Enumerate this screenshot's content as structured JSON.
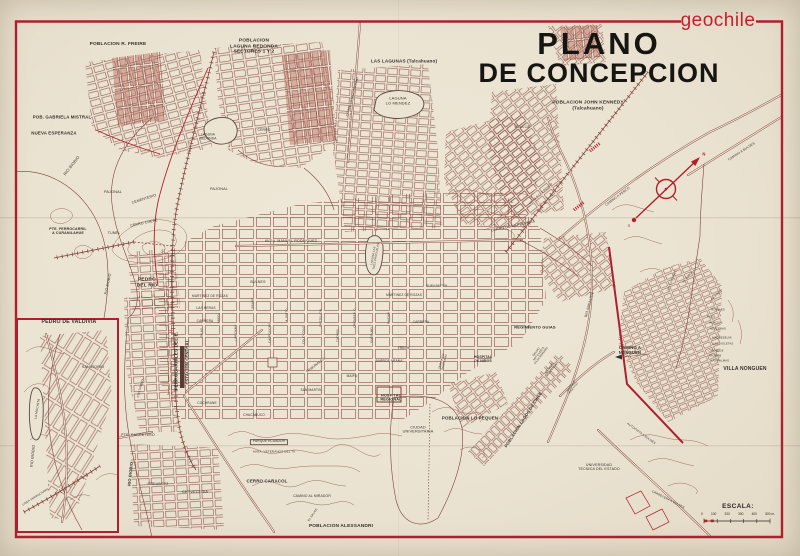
{
  "header": {
    "brand": "geochile",
    "title_line1": "PLANO",
    "title_line2": "DE CONCEPCION"
  },
  "scale": {
    "label": "ESCALA:",
    "marks": [
      "0",
      "100",
      "200",
      "300",
      "400",
      "500 m."
    ]
  },
  "colors": {
    "accent_red": "#ad2030",
    "brand_red": "#c2202e",
    "map_line": "#7d4038",
    "paper": "#ebe3d2",
    "ink": "#35302a"
  },
  "map_labels": [
    {
      "n": "poblacion-r-freire",
      "t": "POBLACION R. FREIRE",
      "x": 118,
      "y": 45,
      "s": 4.8,
      "b": true
    },
    {
      "n": "poblacion-laguna-redonda",
      "t": "POBLACION\nLAGUNA REDONDA\nSECTORES 1 Y 2",
      "x": 254,
      "y": 47,
      "s": 4.8,
      "b": true
    },
    {
      "n": "las-lagunas",
      "t": "LAS LAGUNAS (Talcahuano)",
      "x": 404,
      "y": 61,
      "s": 4.6,
      "b": true
    },
    {
      "n": "laguna-lo-mendez",
      "t": "LAGUNA\nLO MENDEZ",
      "x": 398,
      "y": 101,
      "s": 4
    },
    {
      "n": "poblacion-john-kennedy",
      "t": "POBLACION JOHN KENNEDY\n(Talcahuano)",
      "x": 588,
      "y": 106,
      "s": 4.8,
      "b": true
    },
    {
      "n": "pob-gabriela-mistral",
      "t": "POB. GABRIELA MISTRAL",
      "x": 62,
      "y": 117,
      "s": 4.4,
      "b": true
    },
    {
      "n": "nueva-esperanza",
      "t": "NUEVA ESPERANZA",
      "x": 54,
      "y": 133,
      "s": 4.4,
      "b": true
    },
    {
      "n": "camino-a-talcahuano",
      "t": "CAMINO A TALCAHUANO",
      "x": 353,
      "y": 97,
      "s": 3.2,
      "r": -75
    },
    {
      "n": "villa-cap",
      "t": "VILLA CAP",
      "x": 523,
      "y": 128,
      "s": 3.2
    },
    {
      "n": "cerro",
      "t": "CERRO",
      "x": 264,
      "y": 131,
      "s": 3.4
    },
    {
      "n": "laguna-redonda-small",
      "t": "LAGUNA\nREDONDA",
      "x": 208,
      "y": 137,
      "s": 3.2
    },
    {
      "n": "rio-biobio-nw",
      "t": "RIO BIOBIO",
      "x": 72,
      "y": 166,
      "s": 4,
      "r": -52
    },
    {
      "n": "pajonal-w",
      "t": "PAJONAL",
      "x": 113,
      "y": 192,
      "s": 3.8
    },
    {
      "n": "pajonal-c",
      "t": "PAJONAL",
      "x": 219,
      "y": 189,
      "s": 3.8
    },
    {
      "n": "cementerio",
      "t": "CEMENTERIO",
      "x": 144,
      "y": 199,
      "s": 3.6,
      "r": -18
    },
    {
      "n": "cerro-chepe",
      "t": "CERRO CHEPE",
      "x": 144,
      "y": 223,
      "s": 3.6,
      "r": -12
    },
    {
      "n": "tunel",
      "t": "TUNEL",
      "x": 114,
      "y": 233,
      "s": 3.6
    },
    {
      "n": "pte-ferrocarril",
      "t": "PTE. FERROCARRIL\nA CURANILAHUE",
      "x": 68,
      "y": 231,
      "s": 3.6,
      "b": true
    },
    {
      "n": "pedro-del-rio",
      "t": "PEDRO\nDEL RIO",
      "x": 147,
      "y": 283,
      "s": 4.8,
      "b": true
    },
    {
      "n": "rio-biobio-w",
      "t": "RIO BIOBIO",
      "x": 108,
      "y": 284,
      "s": 3.6,
      "r": -78
    },
    {
      "n": "ferrocarriles-del-e",
      "t": "FERROCARRILES DEL E.",
      "x": 176,
      "y": 361,
      "s": 4.6,
      "r": -90,
      "b": true
    },
    {
      "n": "estacion-central",
      "t": "ESTACION CENTRAL",
      "x": 188,
      "y": 362,
      "s": 4.2,
      "r": -90,
      "b": true
    },
    {
      "n": "pte-carretero",
      "t": "PTE. CARRETERO",
      "x": 138,
      "y": 435,
      "s": 3.6
    },
    {
      "n": "costanera",
      "t": "COSTANERA",
      "x": 141,
      "y": 388,
      "s": 3,
      "r": -75
    },
    {
      "n": "rio-biobio-sw",
      "t": "RIO BIOBIO",
      "x": 131,
      "y": 474,
      "s": 4,
      "r": -84,
      "b": true
    },
    {
      "n": "fernandez",
      "t": "FERNANDEZ",
      "x": 158,
      "y": 485,
      "s": 3.2
    },
    {
      "n": "cerveceria",
      "t": "CERVECERIA",
      "x": 195,
      "y": 492,
      "s": 3.8
    },
    {
      "n": "pedro-de-valdivia-title",
      "t": "PEDRO DE VALDIVIA",
      "x": 69,
      "y": 323,
      "s": 5.2,
      "b": true
    },
    {
      "n": "sanatorio",
      "t": "SANATORIO",
      "x": 93,
      "y": 367,
      "s": 3.6
    },
    {
      "n": "la-mochita",
      "t": "LA MOCHITA",
      "x": 38,
      "y": 409,
      "s": 3.2,
      "r": -80
    },
    {
      "n": "rio-biobio-inset",
      "t": "RIO BIOBIO",
      "x": 33,
      "y": 456,
      "s": 3.8,
      "r": -84
    },
    {
      "n": "linea-ferrocarril",
      "t": "LINEA FERROCARRIL",
      "x": 36,
      "y": 497,
      "s": 2.8,
      "r": -32
    },
    {
      "n": "avda-manuel-rodriguez",
      "t": "AVDA. MANUEL RODRIGUEZ",
      "x": 291,
      "y": 241,
      "s": 3.6
    },
    {
      "n": "bulnes",
      "t": "BULNES",
      "x": 258,
      "y": 282,
      "s": 3.6
    },
    {
      "n": "martinez-de-rozas-w",
      "t": "MARTINEZ DE ROZAS",
      "x": 210,
      "y": 297,
      "s": 3.2
    },
    {
      "n": "martinez-de-rozas-e",
      "t": "MARTINEZ DE ROZAS",
      "x": 404,
      "y": 296,
      "s": 3.2
    },
    {
      "n": "las-heras",
      "t": "LAS HERAS",
      "x": 206,
      "y": 309,
      "s": 3.2
    },
    {
      "n": "carrera-w",
      "t": "CARRERA",
      "x": 205,
      "y": 322,
      "s": 3.2
    },
    {
      "n": "carrera-e",
      "t": "CARRERA",
      "x": 421,
      "y": 323,
      "s": 3.2
    },
    {
      "n": "freire-st",
      "t": "FREIRE",
      "x": 404,
      "y": 349,
      "s": 3.2
    },
    {
      "n": "barros-arana",
      "t": "BARROS ARANA",
      "x": 389,
      "y": 362,
      "s": 3.2
    },
    {
      "n": "maipu",
      "t": "MAIPU",
      "x": 352,
      "y": 377,
      "s": 3.2
    },
    {
      "n": "san-martin",
      "t": "SAN MARTIN",
      "x": 311,
      "y": 391,
      "s": 3.2
    },
    {
      "n": "cochrane",
      "t": "COCHRANE",
      "x": 207,
      "y": 404,
      "s": 3.2
    },
    {
      "n": "chacabuco",
      "t": "CHACABUCO",
      "x": 254,
      "y": 416,
      "s": 3.2
    },
    {
      "n": "tribunales",
      "t": "TRIBUNALES",
      "x": 316,
      "y": 366,
      "s": 3.4,
      "r": -38
    },
    {
      "n": "salas",
      "t": "SALAS",
      "x": 202,
      "y": 333,
      "s": 2.8,
      "r": -90
    },
    {
      "n": "angol",
      "t": "ANGOL",
      "x": 219,
      "y": 318,
      "s": 2.8,
      "r": -90
    },
    {
      "n": "lincoyan",
      "t": "LINCOYAN",
      "x": 236,
      "y": 333,
      "s": 2.8,
      "r": -90
    },
    {
      "n": "rengo",
      "t": "RENGO",
      "x": 253,
      "y": 303,
      "s": 2.8,
      "r": -90
    },
    {
      "n": "caupolican",
      "t": "CAUPOLICAN",
      "x": 270,
      "y": 333,
      "s": 2.8,
      "r": -90
    },
    {
      "n": "a-pinto",
      "t": "A. PINTO",
      "x": 287,
      "y": 315,
      "s": 2.8,
      "r": -90
    },
    {
      "n": "colo-colo",
      "t": "COLO COLO",
      "x": 304,
      "y": 335,
      "s": 2.8,
      "r": -90
    },
    {
      "n": "castellon",
      "t": "CASTELLON",
      "x": 321,
      "y": 318,
      "s": 2.8,
      "r": -90
    },
    {
      "n": "tucapel",
      "t": "TUCAPEL",
      "x": 338,
      "y": 335,
      "s": 2.8,
      "r": -90
    },
    {
      "n": "orompello",
      "t": "OROMPELLO",
      "x": 355,
      "y": 318,
      "s": 2.8,
      "r": -90
    },
    {
      "n": "ongolmo",
      "t": "ONGOLMO",
      "x": 372,
      "y": 335,
      "s": 2.8,
      "r": -90
    },
    {
      "n": "paicavi",
      "t": "PAICAVI",
      "x": 389,
      "y": 318,
      "s": 2.8,
      "r": -90
    },
    {
      "n": "hospital-regional",
      "t": "HOSPITAL\nREGIONAL",
      "x": 391,
      "y": 398,
      "s": 3.8,
      "b": true
    },
    {
      "n": "ciudad-universitaria",
      "t": "CIUDAD\nUNIVERSITARIA",
      "x": 418,
      "y": 430,
      "s": 3.8
    },
    {
      "n": "parque-ecuador",
      "t": "PARQUE ECUADOR",
      "x": 269,
      "y": 442,
      "s": 3.2,
      "box": true
    },
    {
      "n": "avda-veteranos",
      "t": "AVDA. VETERANOS DEL 79",
      "x": 274,
      "y": 452,
      "s": 3
    },
    {
      "n": "cerro-caracol",
      "t": "CERRO CARACOL",
      "x": 267,
      "y": 481,
      "s": 4.4,
      "b": true
    },
    {
      "n": "camino-al-mirador",
      "t": "CAMINO AL MIRADOR",
      "x": 312,
      "y": 497,
      "s": 3.4
    },
    {
      "n": "el-sauce",
      "t": "EL SAUCE",
      "x": 313,
      "y": 515,
      "s": 2.8,
      "r": -55
    },
    {
      "n": "poblacion-alessandri",
      "t": "POBLACION ALESSANDRI",
      "x": 341,
      "y": 527,
      "s": 4.8,
      "b": true
    },
    {
      "n": "poblacion-lo-pequen",
      "t": "POBLACION LO PEQUEN",
      "x": 470,
      "y": 418,
      "s": 4.4,
      "b": true
    },
    {
      "n": "hospital-de-ninos",
      "t": "HOSPITAL\nDE NIÑOS",
      "x": 483,
      "y": 360,
      "s": 3.4,
      "b": true
    },
    {
      "n": "regimiento-guias",
      "t": "REGIMIENTO GUIAS",
      "x": 535,
      "y": 328,
      "s": 4,
      "b": true
    },
    {
      "n": "grupo-artilleria",
      "t": "GRUPO\nARTILLERIA\nSILVA RENARD",
      "x": 539,
      "y": 354,
      "s": 2.7,
      "r": -52
    },
    {
      "n": "estadio-municipal",
      "t": "ESTADIO\nMUNICIPAL",
      "x": 551,
      "y": 369,
      "s": 2.7,
      "r": -52
    },
    {
      "n": "estadio-atletico",
      "t": "ESTADIO\nATLETICO",
      "x": 573,
      "y": 388,
      "s": 2.6,
      "r": -52
    },
    {
      "n": "poblacion-lagos-de-chile",
      "t": "POBLACION LAGOS DE CHILE",
      "x": 524,
      "y": 420,
      "s": 4.2,
      "r": -57,
      "b": true
    },
    {
      "n": "rio-andalien",
      "t": "RIO ANDALIEN",
      "x": 590,
      "y": 305,
      "s": 3.4,
      "r": -75
    },
    {
      "n": "seminario-salesiano",
      "t": "SEMINARIO\nSALESIANO",
      "x": 444,
      "y": 362,
      "s": 2.6,
      "r": -75
    },
    {
      "n": "buen-pastor",
      "t": "BUEN PASTOR",
      "x": 437,
      "y": 286,
      "s": 2.7
    },
    {
      "n": "universidad-tecnica",
      "t": "UNIVERSIDAD\nTECNICA DEL ESTADO",
      "x": 599,
      "y": 467,
      "s": 3.6
    },
    {
      "n": "autopista-a-bulnes",
      "t": "AUTOPISTA A BULNES",
      "x": 641,
      "y": 434,
      "s": 3,
      "r": 36
    },
    {
      "n": "carretera-a-bulnes",
      "t": "CARRETERA A BULNES",
      "x": 668,
      "y": 500,
      "s": 3,
      "r": 27
    },
    {
      "n": "cerro-de-la-polvora",
      "t": "CERRO DE LA POLVORA",
      "x": 513,
      "y": 226,
      "s": 3.6,
      "r": -12
    },
    {
      "n": "linea-fc-a-penco",
      "t": "LINEA F.C. A PENCO",
      "x": 541,
      "y": 194,
      "s": 2.9,
      "r": -42
    },
    {
      "n": "camino-a-penco",
      "t": "CAMINO A PENCO",
      "x": 618,
      "y": 197,
      "s": 3.2,
      "r": -37
    },
    {
      "n": "camino-a-bulnes",
      "t": "CAMINO A BULNES",
      "x": 742,
      "y": 152,
      "s": 3.2,
      "r": -33
    },
    {
      "n": "camino-a-nonguen",
      "t": "CAMINO A\nNONGUEN",
      "x": 630,
      "y": 351,
      "s": 4.2,
      "b": true
    },
    {
      "n": "villa-nonguen",
      "t": "VILLA NONGUEN",
      "x": 745,
      "y": 370,
      "s": 5,
      "b": true
    },
    {
      "n": "los-pinos",
      "t": "LOS PINOS",
      "x": 716,
      "y": 296,
      "s": 2.7,
      "r": -45
    },
    {
      "n": "el-roble",
      "t": "EL ROBLE",
      "x": 688,
      "y": 277,
      "s": 2.7,
      "r": -50
    },
    {
      "n": "los-castanos",
      "t": "LOS CASTAÑOS",
      "x": 672,
      "y": 281,
      "s": 2.7,
      "r": -68
    },
    {
      "n": "rosales",
      "t": "ROSALES",
      "x": 718,
      "y": 310,
      "s": 2.7
    },
    {
      "n": "tilos",
      "t": "TILOS",
      "x": 711,
      "y": 317,
      "s": 2.7
    },
    {
      "n": "acacios",
      "t": "ACACIOS",
      "x": 716,
      "y": 323,
      "s": 2.7
    },
    {
      "n": "azucenas",
      "t": "AZUCENAS",
      "x": 718,
      "y": 329,
      "s": 2.7
    },
    {
      "n": "madreselva",
      "t": "MADRESELVA",
      "x": 722,
      "y": 338,
      "s": 2.7
    },
    {
      "n": "las-violetas",
      "t": "LAS VIOLETAS",
      "x": 723,
      "y": 344,
      "s": 2.7
    },
    {
      "n": "ciruelos",
      "t": "CIRUELOS",
      "x": 716,
      "y": 351,
      "s": 2.7
    },
    {
      "n": "aromos",
      "t": "AROMOS",
      "x": 715,
      "y": 356,
      "s": 2.7
    },
    {
      "n": "las-palmas",
      "t": "LAS PALMAS",
      "x": 720,
      "y": 361,
      "s": 2.7
    },
    {
      "n": "laguna-tres-pascualas",
      "t": "LAGUNA LAS\nTRES PASCUALAS",
      "x": 375,
      "y": 256,
      "s": 2.8,
      "r": -80
    },
    {
      "n": "compass-n",
      "t": "N",
      "x": 704,
      "y": 155,
      "s": 4.2,
      "b": true,
      "c": "#b0202a"
    },
    {
      "n": "compass-s",
      "t": "S",
      "x": 629,
      "y": 226,
      "s": 3.8,
      "c": "#b0202a"
    }
  ]
}
